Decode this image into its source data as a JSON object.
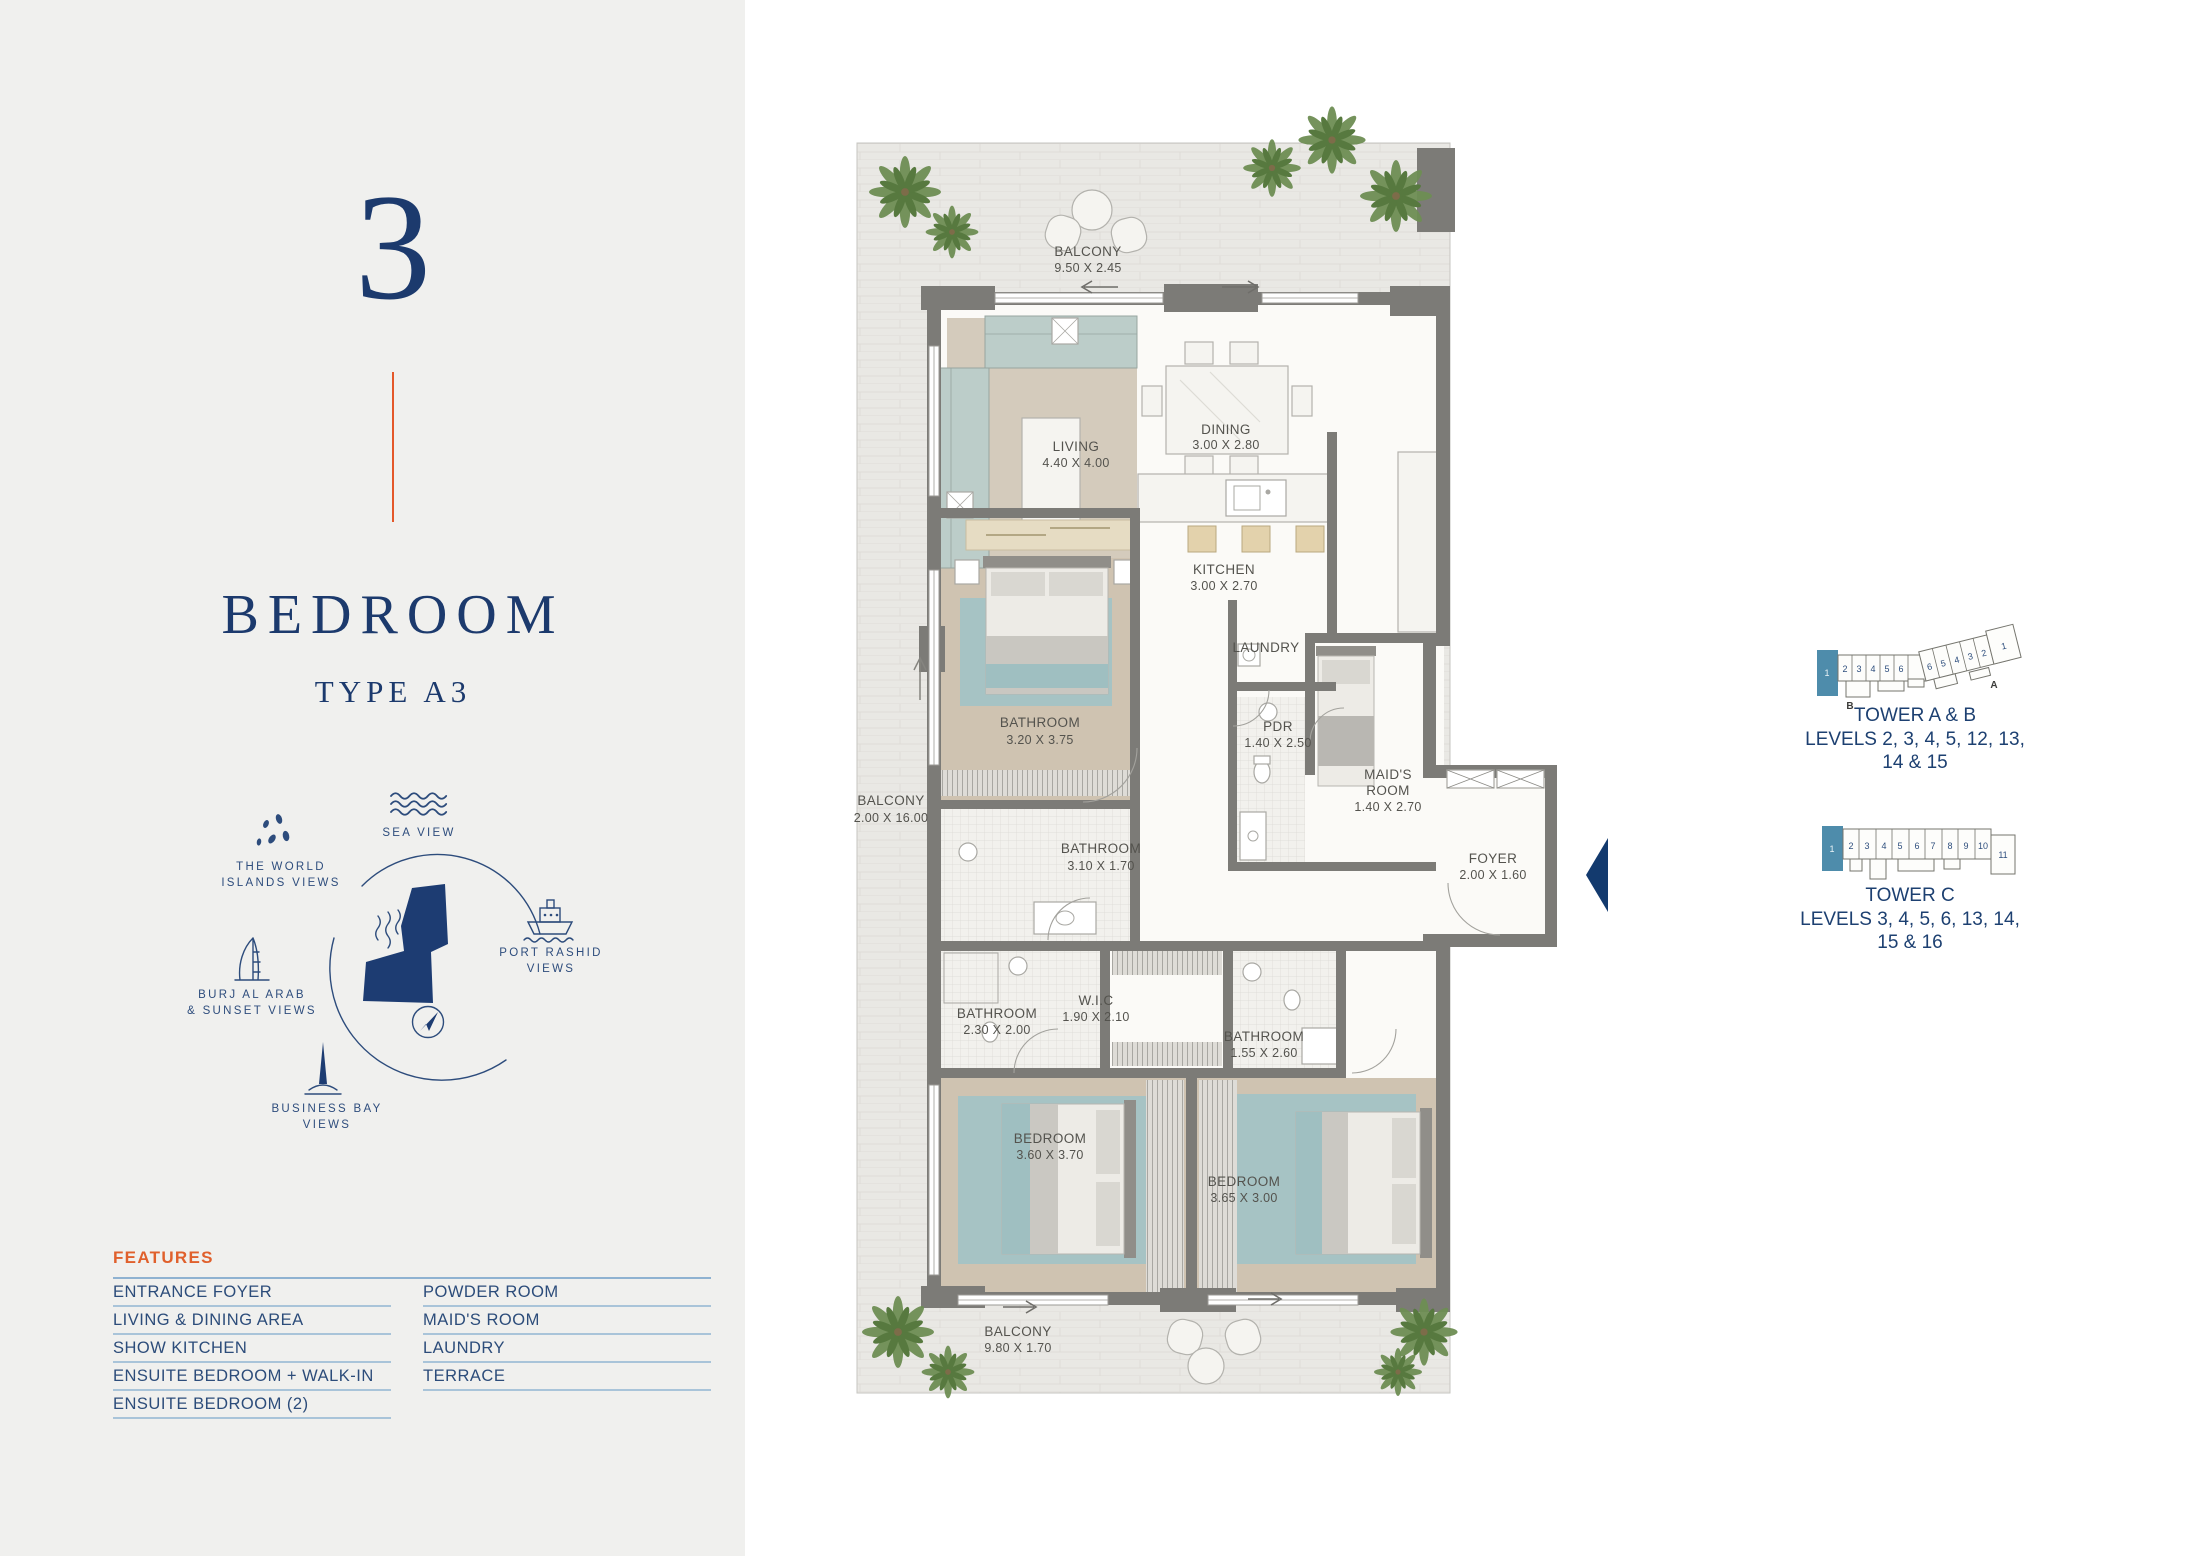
{
  "sidebar": {
    "number": "3",
    "title": "BEDROOM",
    "subtitle": "TYPE A3",
    "views": {
      "sea": "SEA VIEW",
      "world_line1": "THE WORLD",
      "world_line2": "ISLANDS VIEWS",
      "burj_line1": "BURJ AL ARAB",
      "burj_line2": "& SUNSET VIEWS",
      "port_line1": "PORT RASHID",
      "port_line2": "VIEWS",
      "business_line1": "BUSINESS BAY",
      "business_line2": "VIEWS"
    },
    "features": {
      "heading": "FEATURES",
      "col1": [
        "ENTRANCE FOYER",
        "LIVING & DINING AREA",
        "SHOW KITCHEN",
        "ENSUITE BEDROOM + WALK-IN",
        "ENSUITE BEDROOM (2)"
      ],
      "col2": [
        "POWDER ROOM",
        "MAID'S ROOM",
        "LAUNDRY",
        "TERRACE"
      ]
    }
  },
  "plan": {
    "rooms": [
      {
        "name": "BALCONY",
        "dims": "9.50 X 2.45"
      },
      {
        "name": "LIVING",
        "dims": "4.40 X 4.00"
      },
      {
        "name": "DINING",
        "dims": "3.00 X 2.80"
      },
      {
        "name": "KITCHEN",
        "dims": "3.00 X 2.70"
      },
      {
        "name": "LAUNDRY",
        "dims": ""
      },
      {
        "name": "BATHROOM",
        "dims": "3.20 X 3.75"
      },
      {
        "name": "PDR",
        "dims": "1.40 X 2.50"
      },
      {
        "name": "MAID'S",
        "name2": "ROOM",
        "dims": "1.40 X 2.70"
      },
      {
        "name": "BALCONY",
        "dims": "2.00 X 16.00"
      },
      {
        "name": "BATHROOM",
        "dims": "3.10 X 1.70"
      },
      {
        "name": "FOYER",
        "dims": "2.00 X 1.60"
      },
      {
        "name": "BATHROOM",
        "dims": "2.30 X 2.00"
      },
      {
        "name": "W.I.C",
        "dims": "1.90 X 2.10"
      },
      {
        "name": "BATHROOM",
        "dims": "1.55 X 2.60"
      },
      {
        "name": "BEDROOM",
        "dims": "3.60 X 3.70"
      },
      {
        "name": "BEDROOM",
        "dims": "3.65 X 3.00"
      },
      {
        "name": "BALCONY",
        "dims": "9.80 X 1.70"
      }
    ]
  },
  "towers": {
    "ab": {
      "title": "TOWER A & B",
      "levels_line1": "LEVELS 2, 3, 4, 5, 12, 13,",
      "levels_line2": "14 & 15",
      "wing_b_units": [
        "2",
        "3",
        "4",
        "5",
        "6"
      ],
      "wing_a_units": [
        "6",
        "5",
        "4",
        "3",
        "2"
      ],
      "end_unit": "1",
      "highlight_unit": "1",
      "label_a": "A",
      "label_b": "B"
    },
    "c": {
      "title": "TOWER C",
      "levels_line1": "LEVELS 3, 4, 5, 6, 13, 14,",
      "levels_line2": "15 & 16",
      "units": [
        "2",
        "3",
        "4",
        "5",
        "6",
        "7",
        "8",
        "9",
        "10"
      ],
      "end_unit": "11",
      "highlight_unit": "1"
    }
  },
  "colors": {
    "navy": "#1C3A6D",
    "accent_orange": "#E4582A",
    "feature_rule_blue": "#8FB2D1",
    "tower_highlight": "#4E8CAB",
    "wall_gray": "#7C7B77",
    "sidebar_bg": "#F0F0EE"
  }
}
